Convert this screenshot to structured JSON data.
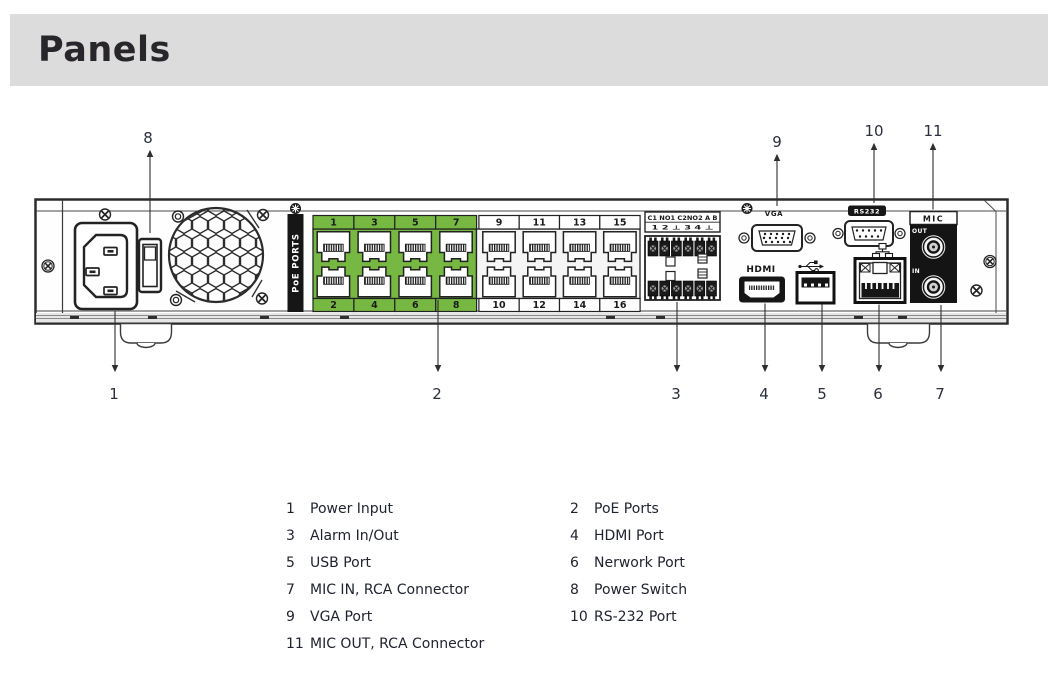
{
  "page": {
    "title": "Panels"
  },
  "device": {
    "poe_bar_label": "PoE PORTS",
    "poe_top": [
      "1",
      "3",
      "5",
      "7",
      "9",
      "11",
      "13",
      "15"
    ],
    "poe_bottom": [
      "2",
      "4",
      "6",
      "8",
      "10",
      "12",
      "14",
      "16"
    ],
    "alarm_row1": "C1 NO1 C2NO2 A B",
    "alarm_row2": "1 2 ⊥ 3 4 ⊥",
    "vga_label": "VGA",
    "hdmi_label": "HDMI",
    "rs232_label": "RS232",
    "mic_label": "MIC",
    "mic_out_label": "OUT",
    "mic_in_label": "IN"
  },
  "callouts": {
    "nums": [
      "1",
      "2",
      "3",
      "4",
      "5",
      "6",
      "7",
      "8",
      "9",
      "10",
      "11"
    ]
  },
  "legend": {
    "items": [
      {
        "num": "1",
        "label": "Power Input"
      },
      {
        "num": "2",
        "label": "PoE Ports"
      },
      {
        "num": "3",
        "label": "Alarm In/Out"
      },
      {
        "num": "4",
        "label": "HDMI Port"
      },
      {
        "num": "5",
        "label": "USB Port"
      },
      {
        "num": "6",
        "label": "Nerwork Port"
      },
      {
        "num": "7",
        "label": "MIC IN, RCA Connector"
      },
      {
        "num": "8",
        "label": "Power Switch"
      },
      {
        "num": "9",
        "label": "VGA Port"
      },
      {
        "num": "10",
        "label": "RS-232 Port"
      },
      {
        "num": "11",
        "label": "MIC OUT, RCA Connector"
      }
    ]
  },
  "colors": {
    "header_bg": "#dcdcdc",
    "poe_green": "#77b843",
    "panel_stroke": "#2b2b2b",
    "callout_text": "#2a2e3d"
  }
}
